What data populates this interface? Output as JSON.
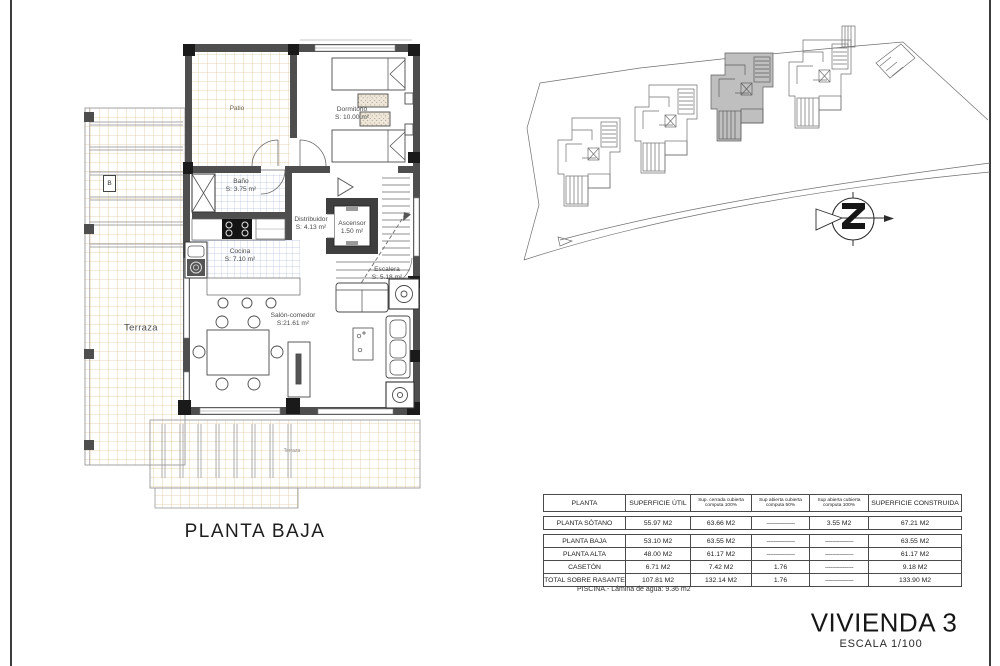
{
  "sheet": {
    "plan_caption": "PLANTA BAJA",
    "title": "VIVIENDA 3",
    "scale": "ESCALA 1/100"
  },
  "floor_plan": {
    "section_marker": "B",
    "rooms": {
      "patio": {
        "name": "Patio"
      },
      "dormitorio": {
        "name": "Dormitorio",
        "area": "S: 10.00 m²"
      },
      "bano": {
        "name": "Baño",
        "area": "S: 3.75 m²"
      },
      "cocina": {
        "name": "Cocina",
        "area": "S: 7.10 m²"
      },
      "distribuidor": {
        "name": "Distribuidor",
        "area": "S: 4.13 m²"
      },
      "ascensor": {
        "name": "Ascensor",
        "area": "1.50 m²"
      },
      "escalera": {
        "name": "Escalera",
        "area": "S: 5.18 m²"
      },
      "salon": {
        "name": "Salón-comedor",
        "area": "S:21.61 m²"
      },
      "terraza": {
        "name": "Terraza"
      },
      "terraza_inferior": {
        "name": "Terraza"
      }
    }
  },
  "table": {
    "headers": [
      "PLANTA",
      "SUPERFICIE ÚTIL",
      "Sup. cerrada cubierta computa 100%",
      "Sup abierta cubierta computa 50%",
      "Sup abierta cubierta computa 100%",
      "SUPERFICIE CONSTRUIDA"
    ],
    "rows": [
      [
        "PLANTA SÓTANO",
        "55.97 M2",
        "63.66 M2",
        "----------------",
        "3.55 M2",
        "67.21 M2"
      ],
      [
        "PLANTA BAJA",
        "53.10 M2",
        "63.55 M2",
        "----------------",
        "----------------",
        "63.55 M2"
      ],
      [
        "PLANTA ALTA",
        "48.00 M2",
        "61.17 M2",
        "----------------",
        "----------------",
        "61.17 M2"
      ],
      [
        "CASETÓN",
        "6.71 M2",
        "7.42 M2",
        "1.76",
        "----------------",
        "9.18 M2"
      ],
      [
        "TOTAL SOBRE RASANTE",
        "107.81 M2",
        "132.14 M2",
        "1.76",
        "----------------",
        "133.90 M2"
      ]
    ],
    "footnote": "PISCINA.- Lámina de agua: 9.36 m2"
  }
}
